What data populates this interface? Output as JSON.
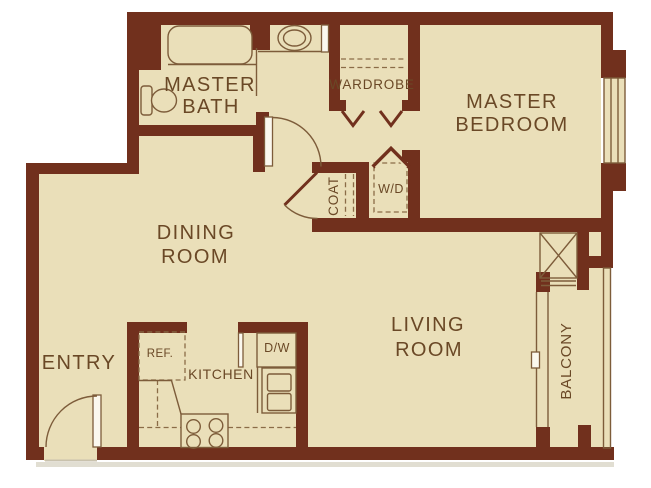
{
  "title": "One-bedroom apartment floor plan",
  "colors": {
    "background": "#ffffff",
    "floor": "#eadfb9",
    "wall": "#71301d",
    "fixture_line": "#7d5c3a",
    "dash_line": "#8a6c47",
    "label_text": "#6a4826",
    "door_fill": "#fbf8ee",
    "shadow": "#c9c2ad"
  },
  "rooms": {
    "master_bath": {
      "line1": "MASTER",
      "line2": "BATH"
    },
    "wardrobe": {
      "label": "WARDROBE"
    },
    "master_bedroom": {
      "line1": "MASTER",
      "line2": "BEDROOM"
    },
    "dining_room": {
      "line1": "DINING",
      "line2": "ROOM"
    },
    "coat_closet": {
      "label": "COAT"
    },
    "laundry": {
      "label": "W/D"
    },
    "living_room": {
      "line1": "LIVING",
      "line2": "ROOM"
    },
    "entry": {
      "label": "ENTRY"
    },
    "kitchen": {
      "label": "KITCHEN"
    },
    "balcony": {
      "label": "BALCONY"
    }
  },
  "appliances": {
    "refrigerator": "REF.",
    "dishwasher": "D/W"
  },
  "fixtures": [
    "bathtub",
    "toilet",
    "vanity-sink",
    "closet-rod",
    "bifold-doors",
    "door-swing",
    "washer-dryer-space",
    "utility-chase",
    "window",
    "sliding-glass-door",
    "balcony-railing",
    "range-burners",
    "double-sink",
    "entry-door"
  ]
}
